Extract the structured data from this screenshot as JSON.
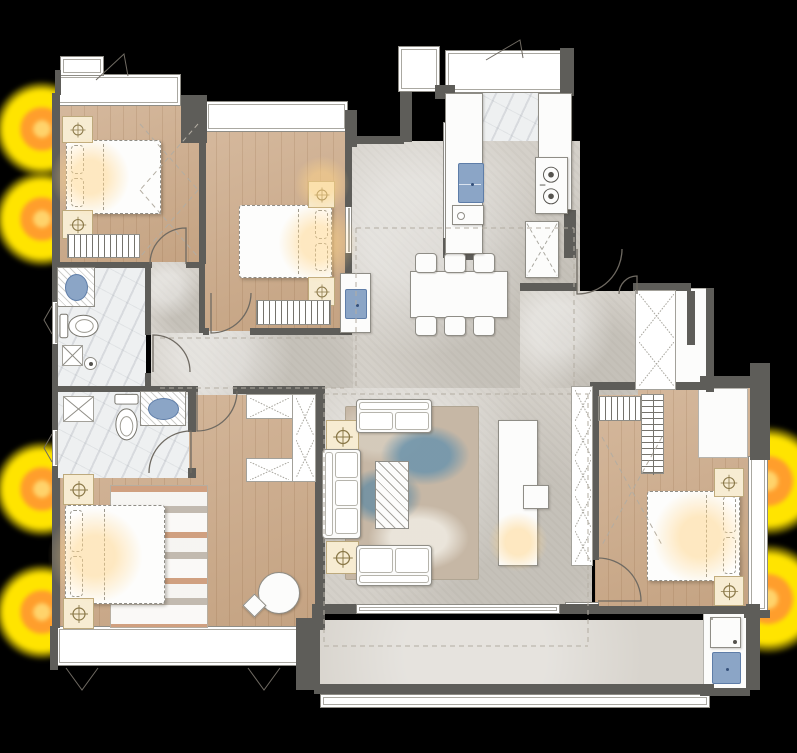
{
  "meta": {
    "title": "apartment-floor-plan"
  },
  "colors": {
    "background": "#000000",
    "wall": "#5e5d59",
    "wood": "#cdab8a",
    "concrete": "#d4d0c9",
    "marble": "#eef0f1",
    "balcony": "#d8d4cd",
    "furniture_line": "#8f8d86",
    "sink_blue": "#8ba5c6",
    "sink_blue_line": "#5e7da8",
    "nightstand_cream": "#f7ecd2",
    "lamp_icon_line": "#8a7848",
    "glow_yellow": "#ffe400",
    "glow_orange": "#ff9e2c",
    "glow_core": "#ffd36b",
    "rug_blue": "#6c94ac",
    "rug_tan": "#c6b7a5",
    "rug_master_orange": "#c67442"
  },
  "glows": [
    {
      "name": "exterior-lamp-glow",
      "x": -6,
      "y": 81,
      "s": 96
    },
    {
      "name": "exterior-lamp-glow",
      "x": -6,
      "y": 171,
      "s": 96
    },
    {
      "name": "exterior-lamp-glow",
      "x": -6,
      "y": 441,
      "s": 96
    },
    {
      "name": "exterior-lamp-glow",
      "x": -6,
      "y": 564,
      "s": 96
    },
    {
      "name": "exterior-lamp-glow",
      "x": 713,
      "y": 426,
      "s": 110
    },
    {
      "name": "exterior-lamp-glow",
      "x": 713,
      "y": 544,
      "s": 110
    }
  ],
  "soft_glows": [
    {
      "name": "bed1-light",
      "x": 50,
      "y": 137,
      "s": 80
    },
    {
      "name": "bed2-light",
      "x": 278,
      "y": 203,
      "s": 80
    },
    {
      "name": "bed2-corner-light",
      "x": 294,
      "y": 156,
      "s": 56
    },
    {
      "name": "master-light",
      "x": 47,
      "y": 508,
      "s": 96
    },
    {
      "name": "bed3-light",
      "x": 652,
      "y": 489,
      "s": 96
    },
    {
      "name": "tv-light",
      "x": 488,
      "y": 512,
      "s": 60
    }
  ],
  "floors": [
    {
      "t": "wood",
      "n": "bedroom1-floor",
      "x": 58,
      "y": 106,
      "w": 143,
      "h": 160
    },
    {
      "t": "wood",
      "n": "bedroom2-floor",
      "x": 203,
      "y": 130,
      "w": 146,
      "h": 204
    },
    {
      "t": "wood",
      "n": "master-bedroom-floor",
      "x": 60,
      "y": 390,
      "w": 257,
      "h": 240
    },
    {
      "t": "wood",
      "n": "bedroom3-floor",
      "x": 595,
      "y": 388,
      "w": 157,
      "h": 226
    },
    {
      "t": "marble",
      "n": "kitchen-floor",
      "x": 452,
      "y": 72,
      "w": 120,
      "h": 182
    },
    {
      "t": "marble",
      "n": "bath1-floor",
      "x": 56,
      "y": 264,
      "w": 90,
      "h": 126
    },
    {
      "t": "marble",
      "n": "bath2-floor",
      "x": 56,
      "y": 390,
      "w": 133,
      "h": 88
    },
    {
      "t": "concrete",
      "n": "dining-floor",
      "x": 348,
      "y": 141,
      "w": 232,
      "h": 254
    },
    {
      "t": "concrete",
      "n": "entry-hall-floor",
      "x": 520,
      "y": 291,
      "w": 118,
      "h": 104
    },
    {
      "t": "concrete",
      "n": "corridor-floor",
      "x": 151,
      "y": 331,
      "w": 202,
      "h": 64
    },
    {
      "t": "concrete",
      "n": "corridor-floor-2",
      "x": 151,
      "y": 262,
      "w": 52,
      "h": 71
    },
    {
      "t": "concrete",
      "n": "living-floor",
      "x": 318,
      "y": 388,
      "w": 274,
      "h": 222
    },
    {
      "t": "balcony",
      "n": "balcony-floor",
      "x": 318,
      "y": 620,
      "w": 394,
      "h": 70
    },
    {
      "t": "white",
      "n": "utility-floor",
      "x": 703,
      "y": 610,
      "w": 44,
      "h": 82
    },
    {
      "t": "white",
      "n": "entry-landing",
      "x": 637,
      "y": 291,
      "w": 50,
      "h": 52
    },
    {
      "t": "white",
      "n": "hall-closet-face",
      "x": 672,
      "y": 288,
      "w": 36,
      "h": 102
    },
    {
      "t": "white",
      "n": "bedroom3-closet-face",
      "x": 698,
      "y": 388,
      "w": 50,
      "h": 70
    }
  ],
  "walls": [
    [
      52,
      93,
      8,
      175
    ],
    [
      55,
      70,
      6,
      25
    ],
    [
      52,
      266,
      6,
      36
    ],
    [
      52,
      344,
      6,
      48
    ],
    [
      52,
      390,
      6,
      40
    ],
    [
      52,
      466,
      6,
      14
    ],
    [
      52,
      478,
      8,
      150
    ],
    [
      50,
      626,
      8,
      44
    ],
    [
      181,
      95,
      26,
      48
    ],
    [
      199,
      141,
      7,
      123
    ],
    [
      199,
      262,
      6,
      71
    ],
    [
      58,
      262,
      94,
      6
    ],
    [
      186,
      262,
      17,
      6
    ],
    [
      145,
      264,
      6,
      71
    ],
    [
      145,
      373,
      6,
      19
    ],
    [
      56,
      386,
      133,
      6
    ],
    [
      188,
      386,
      10,
      6
    ],
    [
      188,
      390,
      8,
      42
    ],
    [
      188,
      468,
      8,
      10
    ],
    [
      233,
      386,
      84,
      8
    ],
    [
      315,
      386,
      10,
      244
    ],
    [
      296,
      618,
      24,
      72
    ],
    [
      345,
      110,
      12,
      37
    ],
    [
      345,
      141,
      7,
      66
    ],
    [
      345,
      253,
      7,
      82
    ],
    [
      203,
      328,
      6,
      7
    ],
    [
      250,
      328,
      101,
      7
    ],
    [
      352,
      136,
      52,
      8
    ],
    [
      400,
      92,
      12,
      50
    ],
    [
      435,
      85,
      20,
      14
    ],
    [
      443,
      238,
      14,
      20
    ],
    [
      560,
      48,
      14,
      48
    ],
    [
      564,
      210,
      12,
      48
    ],
    [
      452,
      252,
      30,
      8
    ],
    [
      567,
      210,
      8,
      40
    ],
    [
      520,
      283,
      57,
      8
    ],
    [
      633,
      283,
      58,
      8
    ],
    [
      687,
      291,
      8,
      54
    ],
    [
      706,
      288,
      8,
      104
    ],
    [
      590,
      382,
      118,
      8
    ],
    [
      700,
      376,
      60,
      12
    ],
    [
      750,
      363,
      20,
      97
    ],
    [
      744,
      610,
      26,
      8
    ],
    [
      592,
      386,
      7,
      174
    ],
    [
      592,
      604,
      7,
      10
    ],
    [
      595,
      606,
      153,
      8
    ],
    [
      318,
      604,
      38,
      10
    ],
    [
      560,
      604,
      32,
      10
    ],
    [
      312,
      604,
      8,
      86
    ],
    [
      314,
      684,
      400,
      10
    ],
    [
      746,
      604,
      14,
      86
    ],
    [
      700,
      688,
      50,
      8
    ]
  ],
  "windows": [
    {
      "n": "bedroom1-bay-window",
      "x": 55,
      "y": 74,
      "w": 126,
      "h": 32
    },
    {
      "n": "window-box",
      "x": 60,
      "y": 56,
      "w": 44,
      "h": 20
    },
    {
      "n": "bedroom2-bay-window",
      "x": 205,
      "y": 101,
      "w": 143,
      "h": 31
    },
    {
      "n": "ac-platform",
      "x": 398,
      "y": 46,
      "w": 42,
      "h": 46
    },
    {
      "n": "kitchen-top-counter-window",
      "x": 445,
      "y": 50,
      "w": 127,
      "h": 43
    },
    {
      "n": "kitchen-window-left",
      "x": 443,
      "y": 122,
      "w": 10,
      "h": 118
    },
    {
      "n": "kitchen-window-right",
      "x": 562,
      "y": 94,
      "w": 10,
      "h": 118
    },
    {
      "n": "bath1-window",
      "x": 52,
      "y": 300,
      "w": 6,
      "h": 46
    },
    {
      "n": "bath2-window",
      "x": 52,
      "y": 428,
      "w": 6,
      "h": 40
    },
    {
      "n": "bedroom2-interior-window",
      "x": 345,
      "y": 205,
      "w": 7,
      "h": 50
    },
    {
      "n": "master-bay-window",
      "x": 56,
      "y": 626,
      "w": 246,
      "h": 40
    },
    {
      "n": "balcony-sliding-door",
      "x": 356,
      "y": 604,
      "w": 204,
      "h": 10
    },
    {
      "n": "bedroom3-bay-window",
      "x": 748,
      "y": 456,
      "w": 20,
      "h": 156
    },
    {
      "n": "bedroom3-threshold",
      "x": 565,
      "y": 602,
      "w": 34,
      "h": 12
    },
    {
      "n": "balcony-railing",
      "x": 320,
      "y": 694,
      "w": 390,
      "h": 14
    }
  ],
  "furniture": [
    {
      "k": "rug-master",
      "n": "master-rug",
      "x": 110,
      "y": 485,
      "w": 98,
      "h": 143
    },
    {
      "k": "rug-living",
      "n": "living-rug",
      "x": 345,
      "y": 406,
      "w": 134,
      "h": 174
    },
    {
      "k": "bed",
      "n": "bed-bedroom1",
      "x": 66,
      "y": 140,
      "w": 95,
      "h": 74,
      "o": "left"
    },
    {
      "k": "bed",
      "n": "bed-bedroom2",
      "x": 239,
      "y": 205,
      "w": 93,
      "h": 73,
      "o": "right"
    },
    {
      "k": "bed",
      "n": "bed-bedroom3",
      "x": 647,
      "y": 491,
      "w": 93,
      "h": 90,
      "o": "right"
    },
    {
      "k": "bed",
      "n": "bed-master",
      "x": 65,
      "y": 505,
      "w": 100,
      "h": 99,
      "o": "left"
    },
    {
      "k": "stand",
      "n": "nightstand-lamp",
      "x": 62,
      "y": 116,
      "w": 31,
      "h": 27
    },
    {
      "k": "stand",
      "n": "nightstand-lamp",
      "x": 62,
      "y": 210,
      "w": 31,
      "h": 29
    },
    {
      "k": "stand",
      "n": "nightstand-lamp",
      "x": 308,
      "y": 181,
      "w": 27,
      "h": 27
    },
    {
      "k": "stand",
      "n": "nightstand-lamp",
      "x": 308,
      "y": 277,
      "w": 27,
      "h": 29
    },
    {
      "k": "stand",
      "n": "nightstand-lamp",
      "x": 714,
      "y": 468,
      "w": 30,
      "h": 29
    },
    {
      "k": "stand",
      "n": "nightstand-lamp",
      "x": 714,
      "y": 576,
      "w": 30,
      "h": 30
    },
    {
      "k": "stand",
      "n": "nightstand-lamp",
      "x": 63,
      "y": 474,
      "w": 31,
      "h": 31
    },
    {
      "k": "stand",
      "n": "nightstand-lamp",
      "x": 63,
      "y": 598,
      "w": 31,
      "h": 31
    },
    {
      "k": "stand",
      "n": "side-table-lamp",
      "x": 326,
      "y": 420,
      "w": 33,
      "h": 33
    },
    {
      "k": "stand",
      "n": "side-table-lamp",
      "x": 326,
      "y": 541,
      "w": 33,
      "h": 33
    },
    {
      "k": "bench",
      "n": "bed-end-bench",
      "x": 67,
      "y": 234,
      "w": 73,
      "h": 24
    },
    {
      "k": "bench",
      "n": "bed-end-bench",
      "x": 256,
      "y": 300,
      "w": 75,
      "h": 25
    },
    {
      "k": "bench",
      "n": "bed-end-bench",
      "x": 598,
      "y": 396,
      "w": 43,
      "h": 25
    },
    {
      "k": "comb",
      "n": "wardrobe-bedroom3",
      "x": 641,
      "y": 394,
      "w": 23,
      "h": 80
    },
    {
      "k": "xbox",
      "n": "master-closet",
      "x": 246,
      "y": 394,
      "w": 47,
      "h": 25,
      "c": 1
    },
    {
      "k": "xbox",
      "n": "master-closet-column",
      "x": 292,
      "y": 394,
      "w": 24,
      "h": 88,
      "c": 2
    },
    {
      "k": "xbox",
      "n": "master-closet-2",
      "x": 246,
      "y": 458,
      "w": 47,
      "h": 24,
      "c": 1
    },
    {
      "k": "xbox",
      "n": "living-storage-column",
      "x": 571,
      "y": 386,
      "w": 22,
      "h": 180,
      "c": 5
    },
    {
      "k": "xbox",
      "n": "entry-shoe-cabinet",
      "x": 635,
      "y": 290,
      "w": 41,
      "h": 100,
      "c": 2
    },
    {
      "k": "sofa",
      "n": "sofa-two-seat-top",
      "x": 356,
      "y": 399,
      "w": 76,
      "h": 34,
      "o": "top"
    },
    {
      "k": "sofa",
      "n": "sofa-two-seat-bottom",
      "x": 356,
      "y": 545,
      "w": 76,
      "h": 41,
      "o": "bottom"
    },
    {
      "k": "sofa",
      "n": "sofa-three-seat",
      "x": 322,
      "y": 449,
      "w": 39,
      "h": 90,
      "o": "left"
    },
    {
      "k": "coffee",
      "n": "coffee-table",
      "x": 375,
      "y": 461,
      "w": 34,
      "h": 68
    },
    {
      "k": "furn",
      "n": "tv-console",
      "x": 498,
      "y": 420,
      "w": 40,
      "h": 146
    },
    {
      "k": "furn",
      "n": "tv-stool",
      "x": 523,
      "y": 485,
      "w": 26,
      "h": 24
    },
    {
      "k": "furn",
      "n": "dining-table",
      "x": 410,
      "y": 271,
      "w": 98,
      "h": 47
    },
    {
      "k": "chair",
      "n": "dining-chair",
      "x": 415,
      "y": 253,
      "w": 22,
      "h": 20
    },
    {
      "k": "chair",
      "n": "dining-chair",
      "x": 444,
      "y": 253,
      "w": 22,
      "h": 20
    },
    {
      "k": "chair",
      "n": "dining-chair",
      "x": 473,
      "y": 253,
      "w": 22,
      "h": 20
    },
    {
      "k": "chair",
      "n": "dining-chair",
      "x": 415,
      "y": 316,
      "w": 22,
      "h": 20
    },
    {
      "k": "chair",
      "n": "dining-chair",
      "x": 444,
      "y": 316,
      "w": 22,
      "h": 20
    },
    {
      "k": "chair",
      "n": "dining-chair",
      "x": 473,
      "y": 316,
      "w": 22,
      "h": 20
    },
    {
      "k": "furn",
      "n": "bar-cabinet",
      "x": 340,
      "y": 273,
      "w": 31,
      "h": 60
    },
    {
      "k": "sinkrect",
      "n": "bar-sink",
      "x": 345,
      "y": 289,
      "w": 22,
      "h": 30
    },
    {
      "k": "furn",
      "n": "kitchen-counter-left",
      "x": 445,
      "y": 93,
      "w": 38,
      "h": 161
    },
    {
      "k": "furn",
      "n": "kitchen-counter-right",
      "x": 538,
      "y": 93,
      "w": 34,
      "h": 117
    },
    {
      "k": "sinkrect",
      "n": "kitchen-sink",
      "x": 458,
      "y": 163,
      "w": 26,
      "h": 40
    },
    {
      "k": "stove",
      "n": "stove",
      "x": 535,
      "y": 157,
      "w": 33,
      "h": 57
    },
    {
      "k": "orbox",
      "n": "kitchen-appliance",
      "x": 452,
      "y": 205,
      "w": 32,
      "h": 20
    },
    {
      "k": "fridge",
      "n": "fridge",
      "x": 525,
      "y": 221,
      "w": 34,
      "h": 57
    },
    {
      "k": "vanity",
      "n": "bath1-vanity",
      "x": 57,
      "y": 267,
      "w": 38,
      "h": 40
    },
    {
      "k": "toilet",
      "n": "bath1-toilet",
      "x": 59,
      "y": 309,
      "w": 43,
      "h": 34,
      "o": "h"
    },
    {
      "k": "drainx",
      "n": "bath1-shower-drain",
      "x": 62,
      "y": 345,
      "w": 21,
      "h": 21
    },
    {
      "k": "drainc",
      "n": "bath1-floor-drain",
      "x": 84,
      "y": 357,
      "w": 13,
      "h": 13
    },
    {
      "k": "drainx",
      "n": "bath2-shower-drain",
      "x": 63,
      "y": 396,
      "w": 31,
      "h": 26
    },
    {
      "k": "toilet",
      "n": "bath2-toilet",
      "x": 112,
      "y": 393,
      "w": 29,
      "h": 55,
      "o": "v"
    },
    {
      "k": "vanity",
      "n": "bath2-vanity",
      "x": 140,
      "y": 391,
      "w": 46,
      "h": 35
    },
    {
      "k": "washer",
      "n": "washing-machine",
      "x": 710,
      "y": 617,
      "w": 31,
      "h": 31
    },
    {
      "k": "sinkrect",
      "n": "laundry-sink",
      "x": 712,
      "y": 652,
      "w": 29,
      "h": 32
    },
    {
      "k": "circlechair",
      "n": "reading-chair",
      "x": 258,
      "y": 572,
      "w": 42,
      "h": 42
    },
    {
      "k": "furn",
      "n": "reading-side-table",
      "x": 246,
      "y": 597,
      "w": 17,
      "h": 17,
      "r": 45
    }
  ],
  "svg": {
    "doors": [
      "M186,264 L186,228 A36,36 0 0 0 150,264",
      "M211,293 L211,333 A40,40 0 0 0 251,293",
      "M153,372 L153,335 A37,37 0 0 1 190,372",
      "M191,473 L191,431 A42,42 0 0 0 149,473",
      "M197,391 L197,431 A40,40 0 0 0 237,391",
      "M598,601 L641,601 A43,43 0 0 0 598,558",
      "M577,249 L577,294 A45,45 0 0 0 622,249",
      "M637,294 L637,276 A18,18 0 0 0 619,294"
    ],
    "casements": [
      "M96,80 L124,54 L128,76",
      "M486,60 L520,40 L523,58",
      "M66,668 L82,690 L98,668",
      "M248,668 L264,690 L280,668",
      "M52,306 L44,320 L52,334",
      "M52,434 L44,448 L52,462"
    ],
    "dashes": [
      "M140,124 L198,190 M198,124 L140,190 M140,190 L198,257 M198,190 L140,257",
      "M602,437 L662,545 M662,437 L602,545",
      "M356,228 H574 M356,228 V386 M574,228 V386",
      "M324,394 H588 M324,394 V646 M588,394 V646 M324,646 H588",
      "M160,338 H344 M160,388 H344"
    ]
  }
}
